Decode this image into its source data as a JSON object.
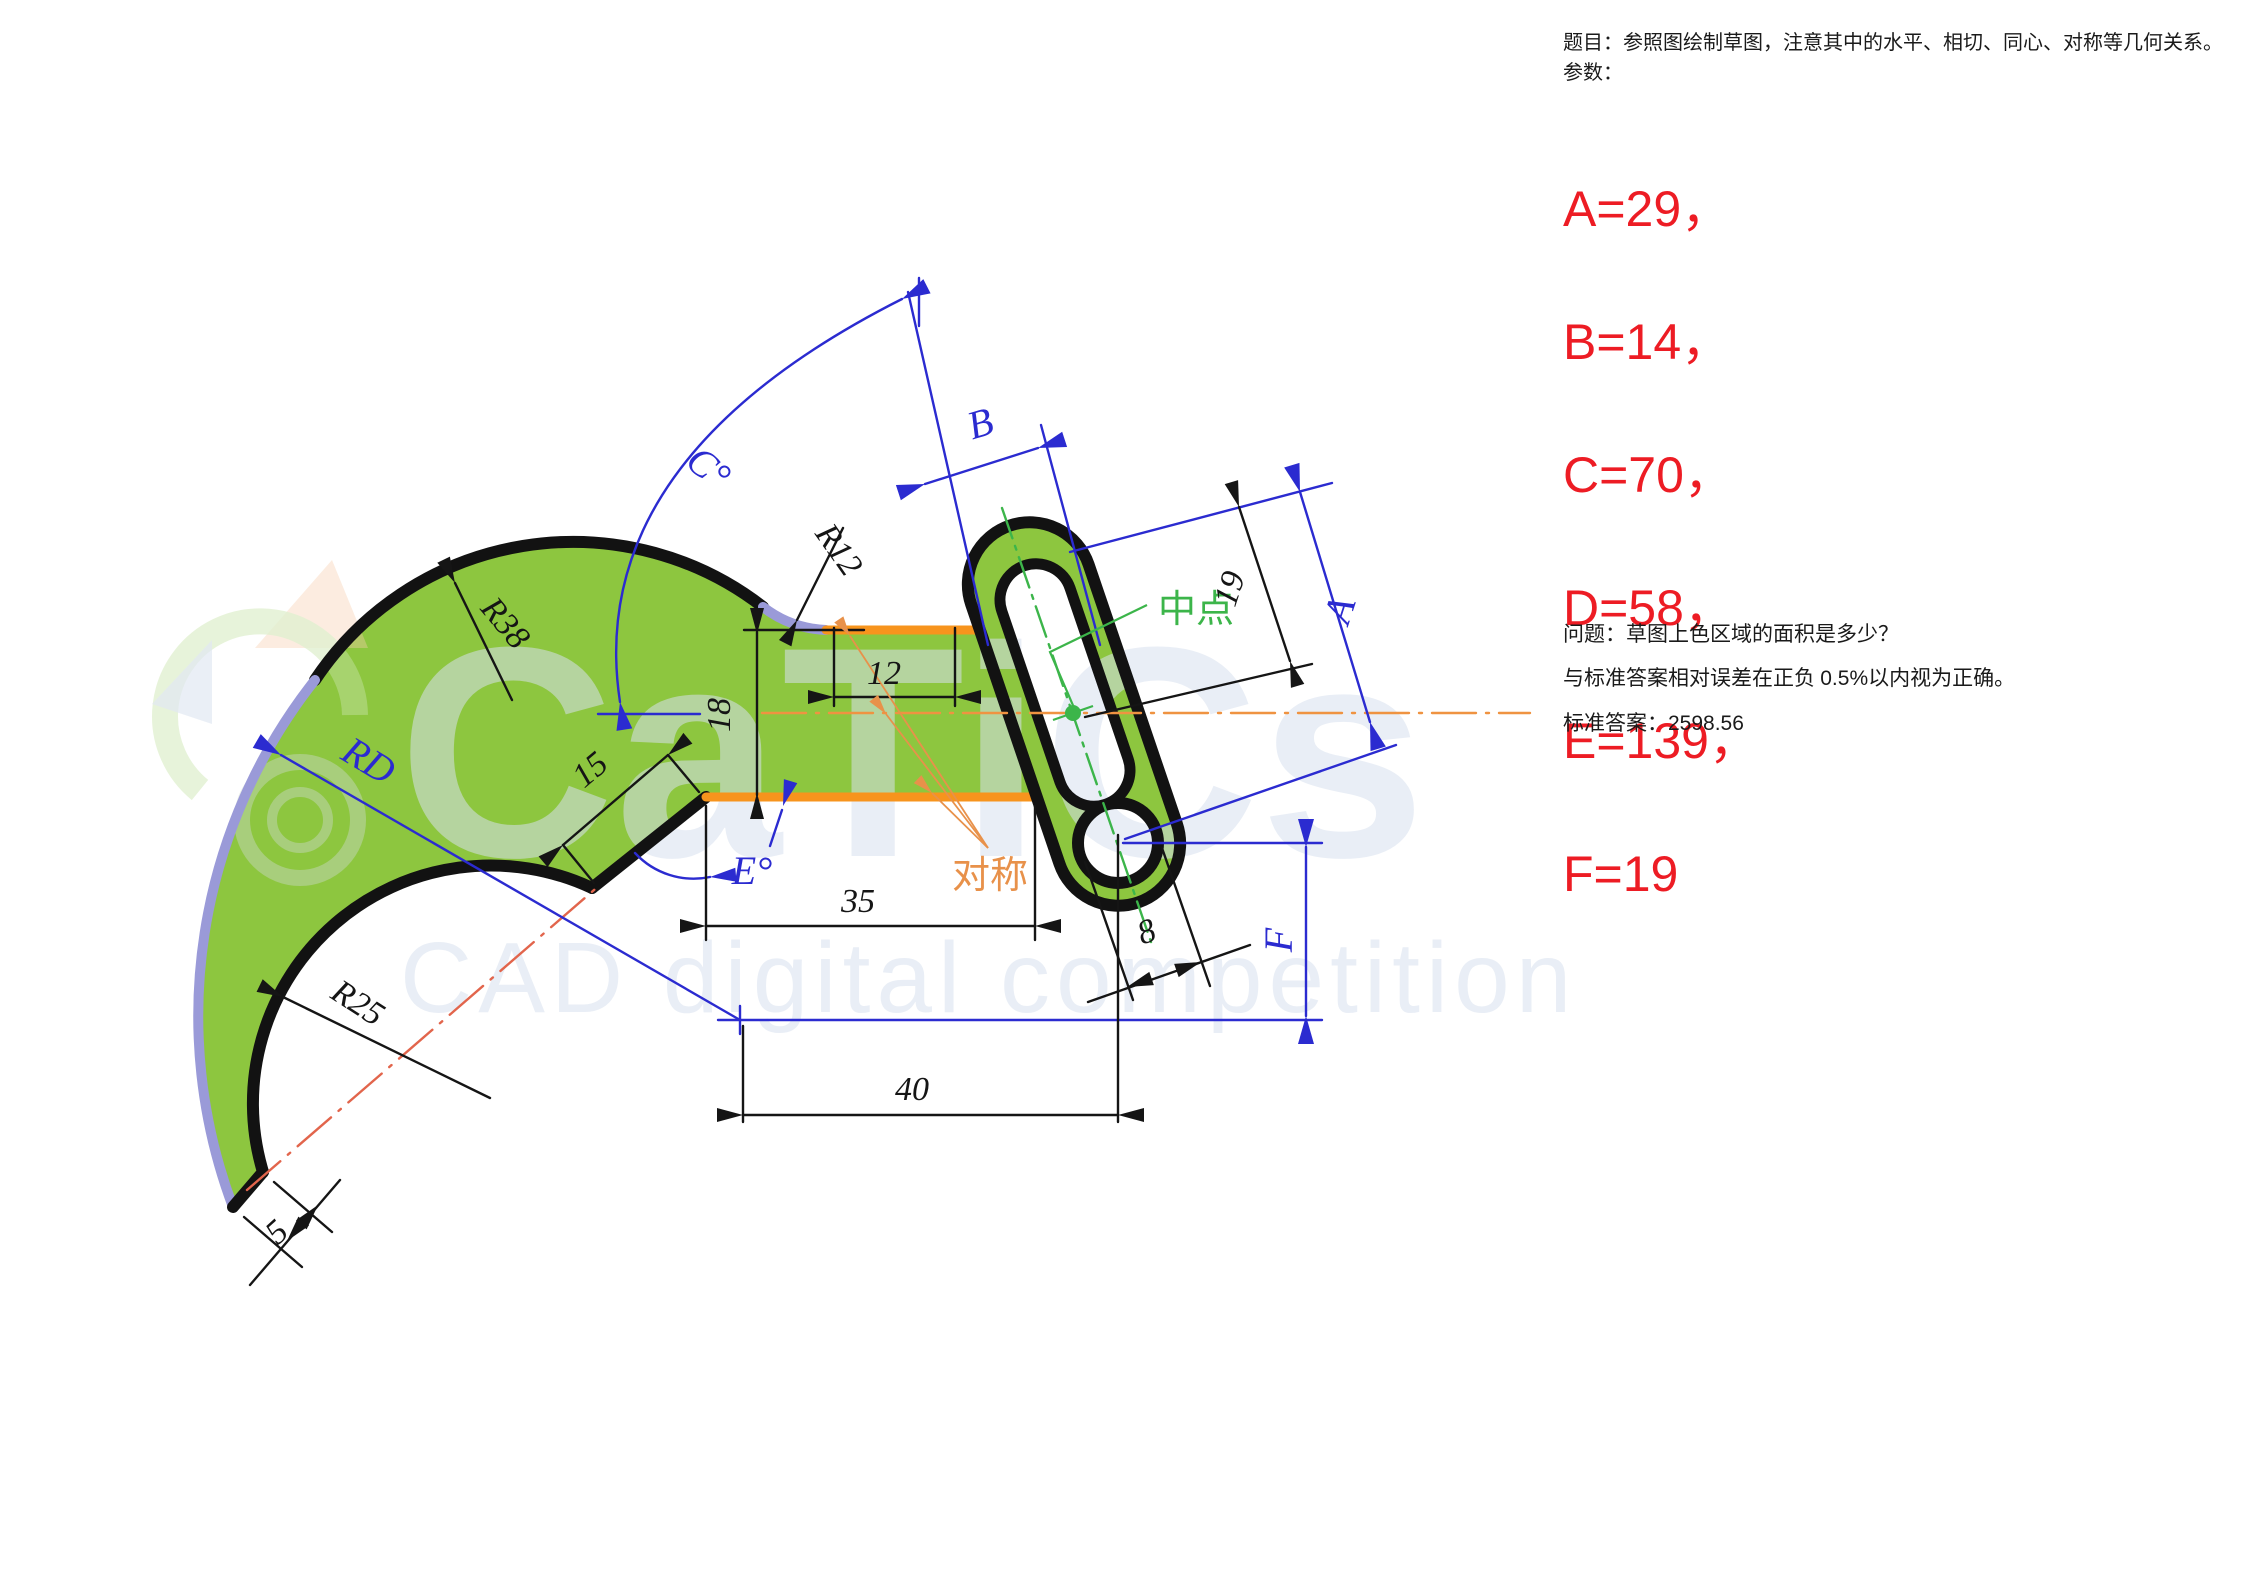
{
  "panel": {
    "title": "题目：参照图绘制草图，注意其中的水平、相切、同心、对称等几何关系。",
    "params_label": "参数：",
    "params": [
      "A=29，",
      "B=14，",
      "C=70，",
      "D=58，",
      "E=139，",
      "F=19"
    ],
    "question": "问题：草图上色区域的面积是多少？",
    "tolerance_prefix": "与标准答案相对误差在正负 ",
    "tolerance_value": "0.5%",
    "tolerance_suffix": "以内视为正确。",
    "answer_label": "标准答案：",
    "answer_value": "2598.56",
    "param_color": "#ed1c24",
    "text_color": "#1a1a1a"
  },
  "drawing": {
    "labels": {
      "r38": "R38",
      "r12": "R12",
      "r25": "R25",
      "rd": "RD",
      "c_angle": "C°",
      "e_angle": "E°",
      "b": "B",
      "a": "A",
      "f": "F",
      "d12": "12",
      "d18": "18",
      "d15": "15",
      "d35": "35",
      "d40": "40",
      "d5": "5",
      "d8": "8",
      "d19": "19",
      "midpoint": "中点",
      "symmetry": "对称"
    },
    "colors": {
      "fill_green": "#8dc63f",
      "outline_black": "#121212",
      "dim_blue": "#2b2bd0",
      "arc_lavender": "#9a9ad8",
      "edge_orange": "#f7941d",
      "centerline_red": "#e2654c",
      "centerline_orange": "#ef9341",
      "note_green": "#3cb54a",
      "note_orange": "#e8914a",
      "watermark": "#d8e1ee"
    }
  },
  "watermark": {
    "brand": "CaTiCs",
    "tagline": "CAD digital competition"
  }
}
